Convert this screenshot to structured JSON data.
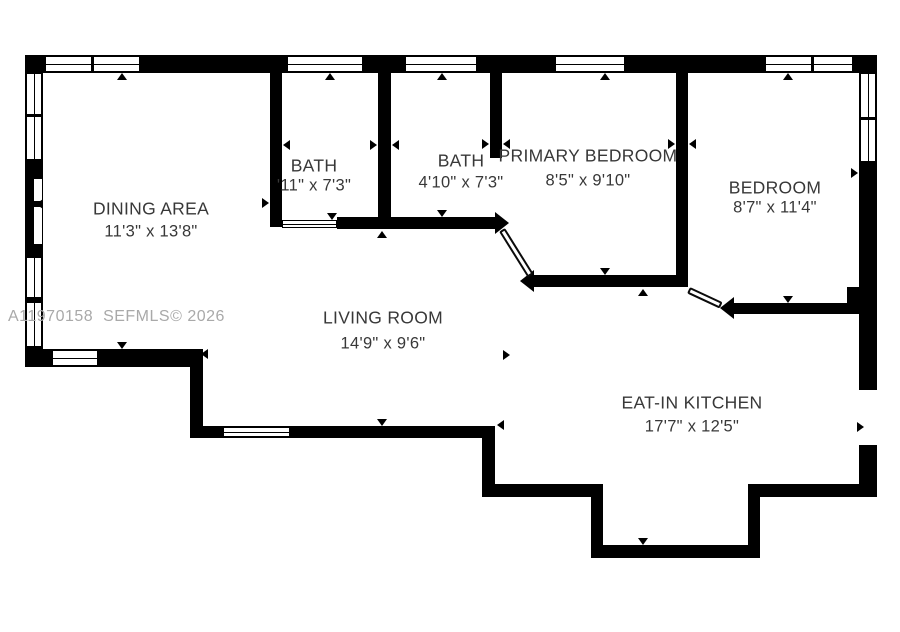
{
  "watermark": {
    "text": "A11970158  SEFMLS© 2026"
  },
  "colors": {
    "wall": "#000000",
    "text": "#383838",
    "watermark": "#a9a9a9",
    "background": "#ffffff"
  },
  "rooms": [
    {
      "id": "dining-area",
      "name": "DINING AREA",
      "dims": "11'3\" x 13'8\"",
      "cx": 151,
      "name_cy": 209,
      "dims_cy": 232
    },
    {
      "id": "bath-1",
      "name": "BATH",
      "dims": "'11\" x 7'3\"",
      "cx": 314,
      "name_cy": 166,
      "dims_cy": 186
    },
    {
      "id": "bath-2",
      "name": "BATH",
      "dims": "4'10\" x 7'3\"",
      "cx": 461,
      "name_cy": 161,
      "dims_cy": 183
    },
    {
      "id": "primary-bedroom",
      "name": "PRIMARY BEDROOM",
      "dims": "8'5\" x 9'10\"",
      "cx": 588,
      "name_cy": 156,
      "dims_cy": 181
    },
    {
      "id": "bedroom",
      "name": "BEDROOM",
      "dims": "8'7\" x 11'4\"",
      "cx": 775,
      "name_cy": 188,
      "dims_cy": 208
    },
    {
      "id": "living-room",
      "name": "LIVING ROOM",
      "dims": "14'9\" x 9'6\"",
      "cx": 383,
      "name_cy": 318,
      "dims_cy": 344
    },
    {
      "id": "eat-in-kitchen",
      "name": "EAT-IN KITCHEN",
      "dims": "17'7\" x 12'5\"",
      "cx": 692,
      "name_cy": 403,
      "dims_cy": 427
    }
  ],
  "floorplan": {
    "walls": [
      {
        "id": "top-wall",
        "x": 25,
        "y": 55,
        "w": 852,
        "h": 18
      },
      {
        "id": "left-wall",
        "x": 25,
        "y": 55,
        "w": 18,
        "h": 312
      },
      {
        "id": "right-wall-upper",
        "x": 859,
        "y": 55,
        "w": 18,
        "h": 335
      },
      {
        "id": "right-wall-lower",
        "x": 859,
        "y": 445,
        "w": 18,
        "h": 52
      },
      {
        "id": "dining-bottom-wall",
        "x": 25,
        "y": 349,
        "w": 178,
        "h": 18
      },
      {
        "id": "dining-step-wall",
        "x": 190,
        "y": 349,
        "w": 13,
        "h": 89
      },
      {
        "id": "living-bottom-wall",
        "x": 190,
        "y": 426,
        "w": 305,
        "h": 12
      },
      {
        "id": "living-step-wall",
        "x": 482,
        "y": 426,
        "w": 13,
        "h": 71
      },
      {
        "id": "kitchen-bottom-left-wall",
        "x": 482,
        "y": 484,
        "w": 121,
        "h": 13
      },
      {
        "id": "alcove-left-wall",
        "x": 591,
        "y": 484,
        "w": 12,
        "h": 74
      },
      {
        "id": "alcove-bottom-wall",
        "x": 591,
        "y": 545,
        "w": 169,
        "h": 13
      },
      {
        "id": "alcove-right-wall",
        "x": 748,
        "y": 497,
        "w": 12,
        "h": 61
      },
      {
        "id": "kitchen-bottom-right-wall",
        "x": 748,
        "y": 484,
        "w": 129,
        "h": 13
      },
      {
        "id": "bath1-left-wall",
        "x": 270,
        "y": 73,
        "w": 12,
        "h": 154
      },
      {
        "id": "bath-divider-wall",
        "x": 378,
        "y": 73,
        "w": 13,
        "h": 156
      },
      {
        "id": "bath2-right-wall",
        "x": 490,
        "y": 73,
        "w": 12,
        "h": 85
      },
      {
        "id": "primary-divider-wall",
        "x": 676,
        "y": 73,
        "w": 12,
        "h": 214
      },
      {
        "id": "bath-bottom-wall",
        "x": 337,
        "y": 217,
        "w": 158,
        "h": 12
      },
      {
        "id": "primary-bottom-wall",
        "x": 534,
        "y": 275,
        "w": 154,
        "h": 12
      },
      {
        "id": "bedroom-bottom-wall",
        "x": 734,
        "y": 303,
        "w": 143,
        "h": 11
      },
      {
        "id": "bedroom-step-block",
        "x": 847,
        "y": 287,
        "w": 30,
        "h": 17
      }
    ],
    "pointed_ends": [
      {
        "id": "bath-bottom-wall-end",
        "x": 495,
        "y": 223,
        "dir": "right"
      },
      {
        "id": "primary-bottom-wall-end",
        "x": 534,
        "y": 281,
        "dir": "left"
      },
      {
        "id": "bedroom-bottom-wall-end",
        "x": 734,
        "y": 308,
        "dir": "left"
      }
    ],
    "windows": [
      {
        "id": "window-top-1",
        "x": 45,
        "y": 56,
        "w": 95,
        "h": 16,
        "orient": "h",
        "dividers": [
          45
        ]
      },
      {
        "id": "window-top-2",
        "x": 287,
        "y": 56,
        "w": 76,
        "h": 16,
        "orient": "h",
        "dividers": []
      },
      {
        "id": "window-top-3",
        "x": 405,
        "y": 56,
        "w": 72,
        "h": 16,
        "orient": "h",
        "dividers": []
      },
      {
        "id": "window-top-4",
        "x": 555,
        "y": 56,
        "w": 70,
        "h": 16,
        "orient": "h",
        "dividers": []
      },
      {
        "id": "window-top-5",
        "x": 765,
        "y": 56,
        "w": 88,
        "h": 16,
        "orient": "h",
        "dividers": [
          45
        ]
      },
      {
        "id": "window-left-1",
        "x": 26,
        "y": 73,
        "w": 16,
        "h": 87,
        "orient": "v",
        "dividers": [
          40
        ]
      },
      {
        "id": "window-left-2",
        "x": 26,
        "y": 257,
        "w": 16,
        "h": 41,
        "orient": "v",
        "dividers": []
      },
      {
        "id": "window-left-3",
        "x": 26,
        "y": 302,
        "w": 16,
        "h": 45,
        "orient": "v",
        "dividers": []
      },
      {
        "id": "window-right-1",
        "x": 860,
        "y": 73,
        "w": 16,
        "h": 89,
        "orient": "v",
        "dividers": [
          43
        ]
      },
      {
        "id": "window-dining-bottom",
        "x": 52,
        "y": 350,
        "w": 46,
        "h": 16,
        "orient": "h",
        "dividers": []
      },
      {
        "id": "window-living-bottom",
        "x": 223,
        "y": 427,
        "w": 67,
        "h": 10,
        "orient": "h",
        "dividers": []
      },
      {
        "id": "door-bath1-opening",
        "x": 282,
        "y": 220,
        "w": 55,
        "h": 8,
        "orient": "h",
        "dividers": []
      }
    ],
    "recess": {
      "x": 33,
      "y": 178,
      "w": 10,
      "h": 67,
      "tick_y": 22,
      "tick_h": 6
    },
    "diagonal_doors": [
      {
        "id": "door-leaf-hallway",
        "x": 505,
        "y": 228,
        "len": 54,
        "thick": 7,
        "angle": 58
      },
      {
        "id": "door-leaf-kitchen",
        "x": 690,
        "y": 287,
        "len": 36,
        "thick": 7,
        "angle": 25
      }
    ],
    "arrows": [
      {
        "x": 122,
        "y": 73,
        "dir": "up"
      },
      {
        "x": 330,
        "y": 73,
        "dir": "up"
      },
      {
        "x": 442,
        "y": 73,
        "dir": "up"
      },
      {
        "x": 605,
        "y": 73,
        "dir": "up"
      },
      {
        "x": 788,
        "y": 73,
        "dir": "up"
      },
      {
        "x": 283,
        "y": 145,
        "dir": "left"
      },
      {
        "x": 377,
        "y": 145,
        "dir": "right"
      },
      {
        "x": 392,
        "y": 145,
        "dir": "left"
      },
      {
        "x": 489,
        "y": 144,
        "dir": "right"
      },
      {
        "x": 503,
        "y": 144,
        "dir": "left"
      },
      {
        "x": 675,
        "y": 144,
        "dir": "right"
      },
      {
        "x": 689,
        "y": 144,
        "dir": "left"
      },
      {
        "x": 269,
        "y": 203,
        "dir": "right"
      },
      {
        "x": 36,
        "y": 204,
        "dir": "left"
      },
      {
        "x": 332,
        "y": 220,
        "dir": "down"
      },
      {
        "x": 442,
        "y": 217,
        "dir": "down"
      },
      {
        "x": 382,
        "y": 231,
        "dir": "up"
      },
      {
        "x": 605,
        "y": 275,
        "dir": "down"
      },
      {
        "x": 643,
        "y": 289,
        "dir": "up"
      },
      {
        "x": 858,
        "y": 173,
        "dir": "right"
      },
      {
        "x": 788,
        "y": 303,
        "dir": "down"
      },
      {
        "x": 510,
        "y": 355,
        "dir": "right"
      },
      {
        "x": 122,
        "y": 349,
        "dir": "down"
      },
      {
        "x": 201,
        "y": 354,
        "dir": "left"
      },
      {
        "x": 382,
        "y": 426,
        "dir": "down"
      },
      {
        "x": 497,
        "y": 425,
        "dir": "left"
      },
      {
        "x": 643,
        "y": 545,
        "dir": "down"
      },
      {
        "x": 864,
        "y": 427,
        "dir": "right"
      }
    ]
  }
}
